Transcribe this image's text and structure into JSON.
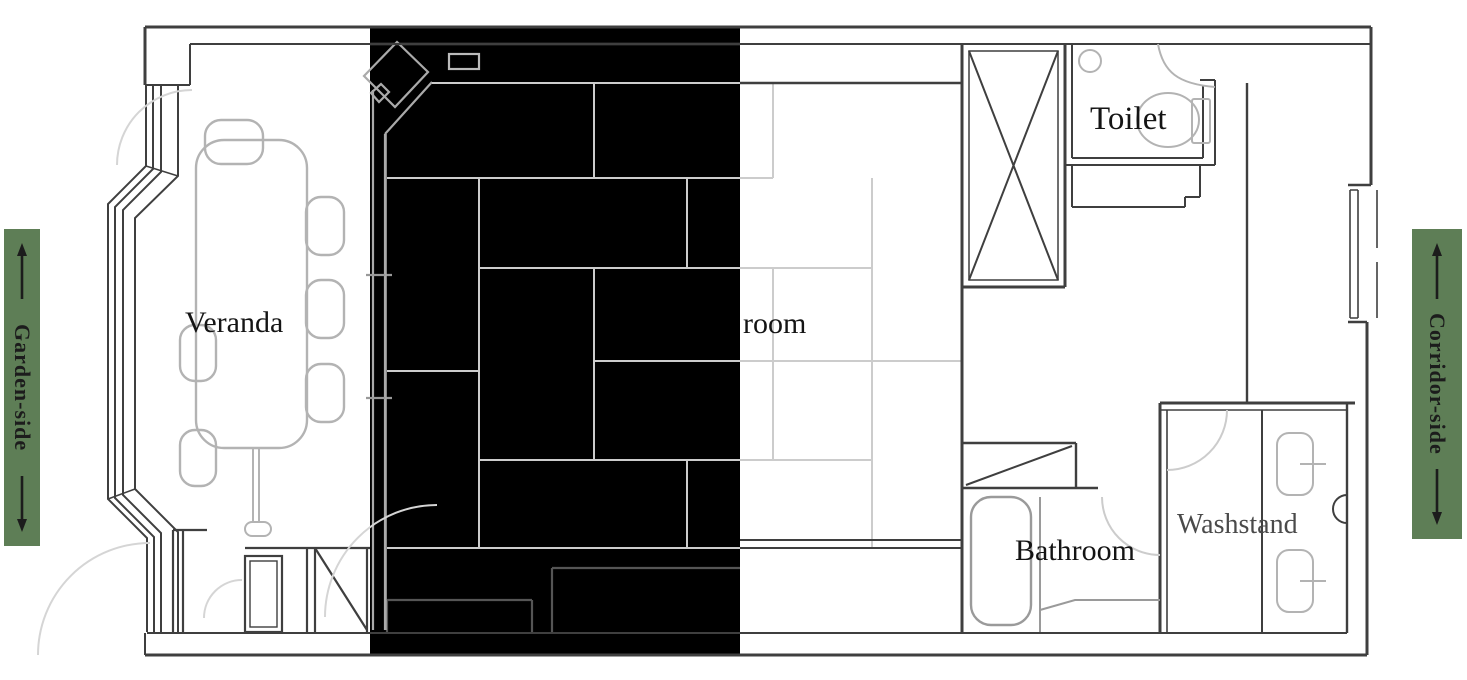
{
  "plan": {
    "labels": {
      "veranda": "Veranda",
      "room": "room",
      "toilet": "Toilet",
      "bathroom": "Bathroom",
      "washstand": "Washstand"
    },
    "banners": {
      "left": "Garden-side",
      "right": "Corridor-side"
    },
    "icons": {
      "up_arrow": "↑",
      "down_arrow": "↓"
    },
    "colors": {
      "banner_green": "#5e7e56",
      "wall_dark": "#3f3f3f",
      "fixture_gray": "#b3b3b3",
      "tatami_gray": "#cccccc",
      "highlight_overlay": "#000000",
      "washstand_text": "#4a4a4a",
      "label_text": "#141414"
    }
  }
}
